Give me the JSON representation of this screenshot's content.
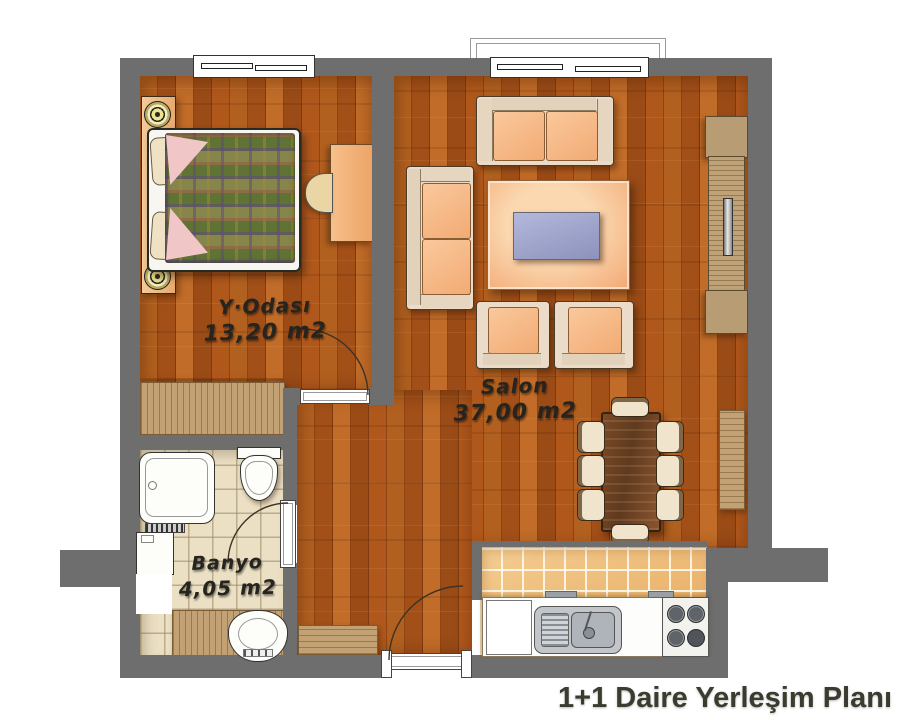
{
  "title": "1+1 Daire Yerleşim Planı",
  "rooms": {
    "bedroom": {
      "name": "Y·Odası",
      "area": "13,20 m2"
    },
    "livingroom": {
      "name": "Salon",
      "area": "37,00 m2"
    },
    "bathroom": {
      "name": "Banyo",
      "area": "4,05 m2"
    }
  },
  "colors": {
    "wall": "#6e6e6e",
    "wood_floor": "#a4561b",
    "kitchen_tile": "#edb368",
    "bathroom_tile": "#ece0c4",
    "furniture_cushion": "#f6bc8c",
    "furniture_frame": "#eadcc8",
    "title_text": "#3b3b30"
  }
}
